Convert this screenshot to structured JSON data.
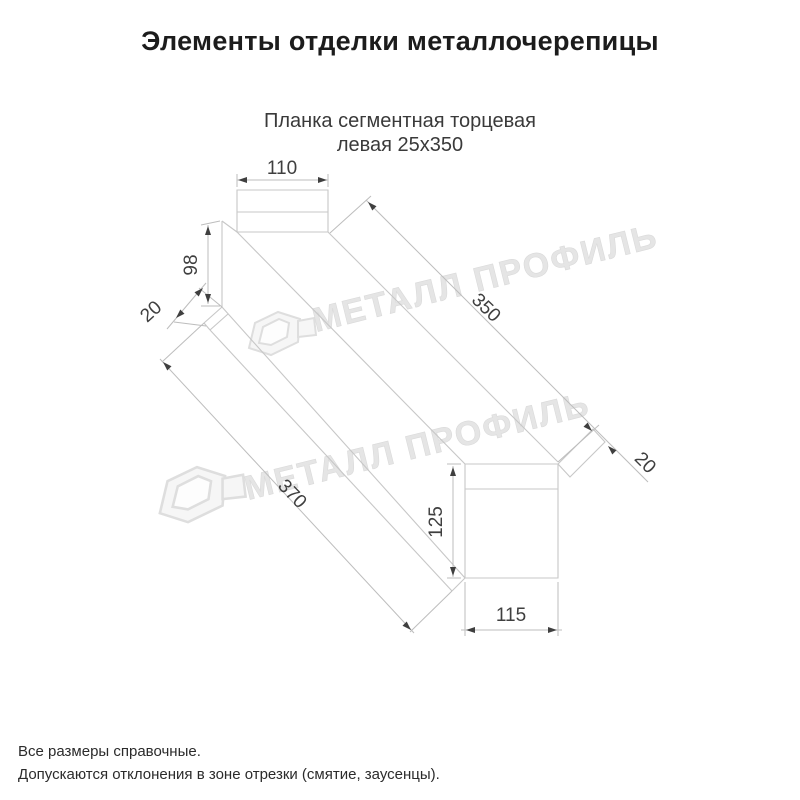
{
  "page": {
    "title": "Элементы отделки металлочерепицы"
  },
  "product": {
    "name_line1": "Планка сегментная торцевая",
    "name_line2": "левая 25х350"
  },
  "drawing": {
    "type": "axonometric-line-drawing",
    "dims": {
      "flange_width": "110",
      "left_height": "98",
      "left_lip": "20",
      "top_length": "350",
      "right_lip": "20",
      "bottom_length": "370",
      "right_height": "125",
      "right_width": "115"
    }
  },
  "watermark": {
    "brand": "МЕТАЛЛ ПРОФИЛЬ"
  },
  "footer": {
    "note1": "Все размеры справочные.",
    "note2": "Допускаются отклонения в зоне отрезки (смятие, заусенцы)."
  },
  "colors": {
    "background": "#ffffff",
    "outline_gray": "#c7c7c7",
    "dimension_dark": "#3f3f3f",
    "title_black": "#1c1c1c",
    "watermark_gray": "#e5e5e5"
  }
}
